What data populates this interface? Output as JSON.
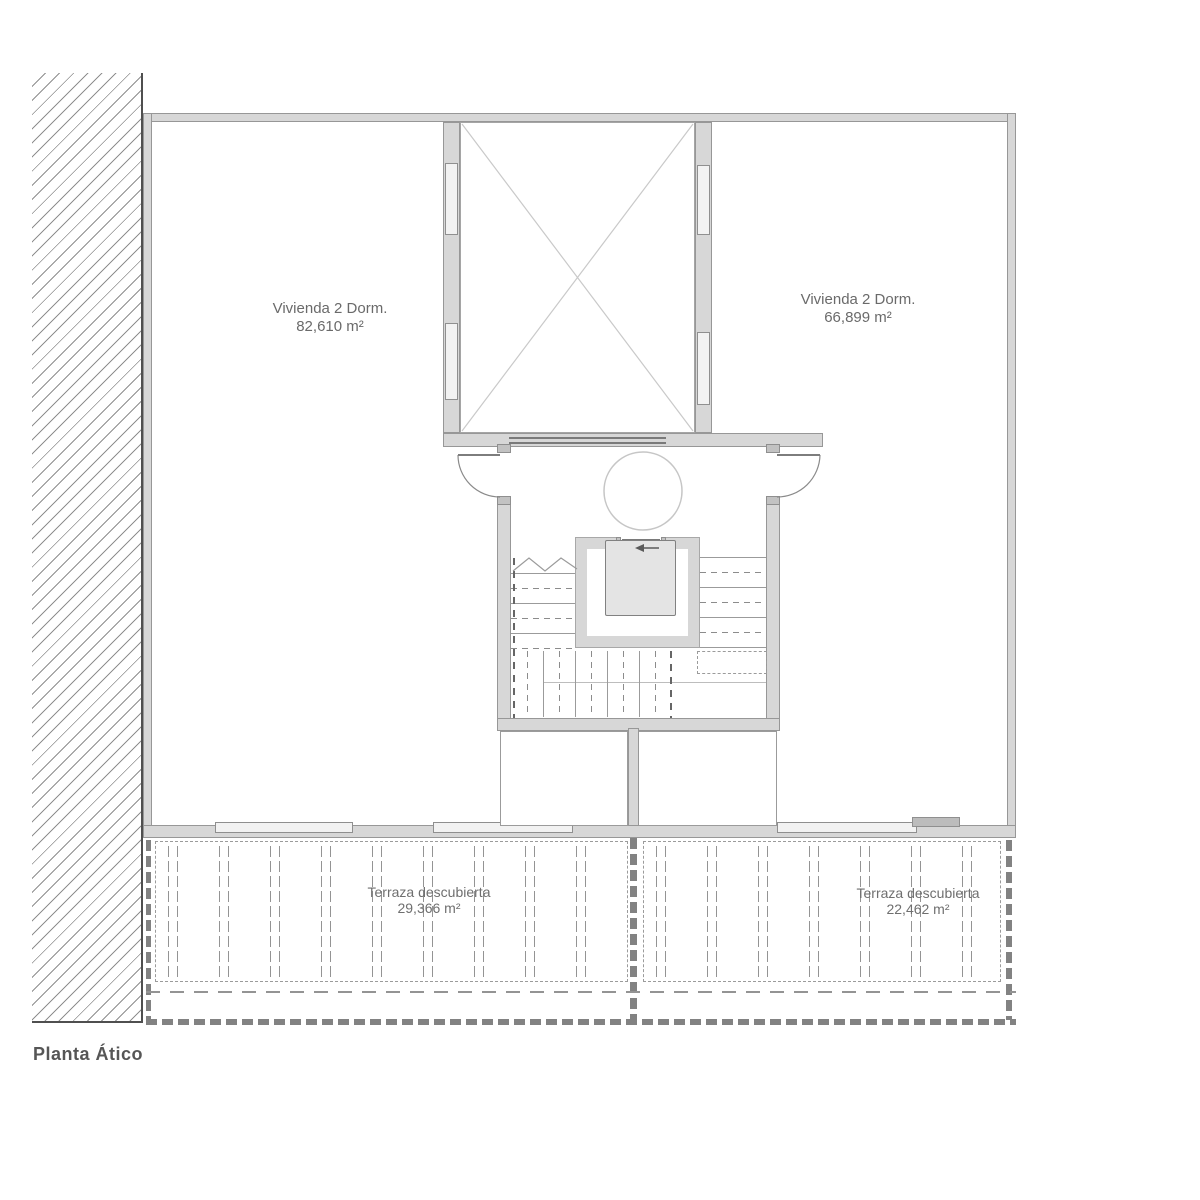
{
  "plan": {
    "title": "Planta Ático",
    "apartments": [
      {
        "name": "Vivienda 2 Dorm.",
        "area": "82,610 m²"
      },
      {
        "name": "Vivienda 2 Dorm.",
        "area": "66,899 m²"
      }
    ],
    "terraces": [
      {
        "name": "Terraza descubierta",
        "area": "29,366 m²"
      },
      {
        "name": "Terraza descubierta",
        "area": "22,462 m²"
      }
    ],
    "icons": {
      "elevator_direction": "left-arrow"
    },
    "colors": {
      "wall_fill": "#d7d7d7",
      "wall_line": "#979797",
      "dash_line": "#828282",
      "draw_line": "#9b9b9b",
      "label_text": "#6a6a6a",
      "title_text": "#565656"
    }
  }
}
